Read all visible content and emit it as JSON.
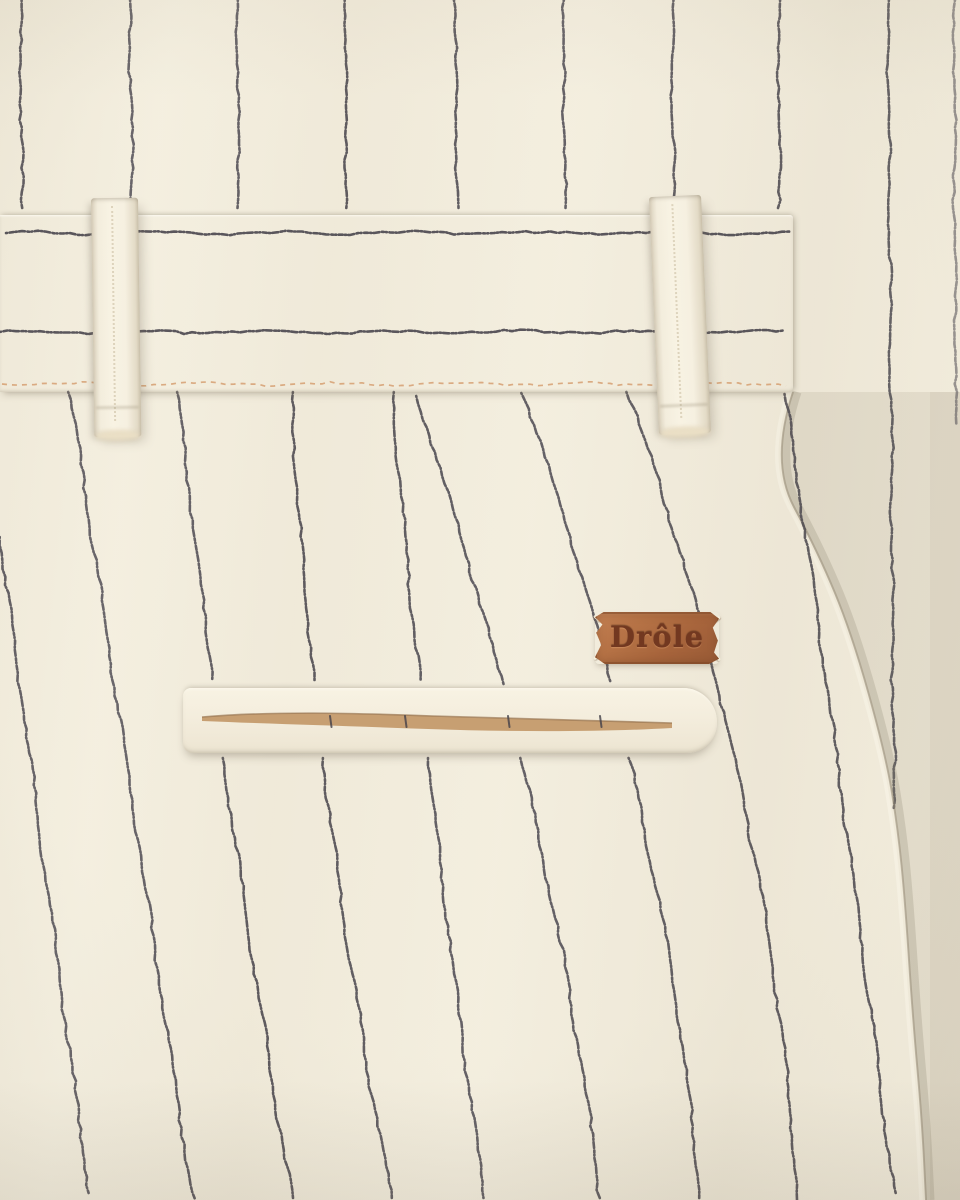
{
  "photo": {
    "subject": "Close-up of cream wool trousers with navy chalk-stripe pattern showing back waistband, belt loops and welt pocket",
    "brand": "Drôle"
  },
  "brand_label": {
    "text": "Drôle",
    "material": "embossed-leather-patch",
    "background": "#ad653a",
    "border": "#8a4c26",
    "text_color": "#6b2d14",
    "stitch_color": "#f6efdc"
  },
  "palette": {
    "fabric_cream": "#f2ecdb",
    "fabric_shadow": "#e4dbc6",
    "stripe_navy": "#3a3740",
    "waistband_highlight": "#f8f2e3",
    "underlayer_shade": "rgba(188,177,154,0.28)",
    "pocket_lining_tan": "#c49a6b",
    "seam_stitch_tan": "#d49a6a"
  },
  "fabric": {
    "stripe_width": 2.6,
    "stripe_opacity": 0.88,
    "dash": "1 2.5 4 2 1.5 2 6 2.5 2 2",
    "top_stripe_y1": 214,
    "top_stripes": [
      20,
      130,
      237,
      345,
      455,
      563,
      672,
      778
    ],
    "long_stripes": [
      {
        "x": 888,
        "drift": 6,
        "y0": 0,
        "y1": 812,
        "opacity": 0.85
      },
      {
        "x": 954,
        "drift": 2,
        "y0": 0,
        "y1": 430,
        "opacity": 0.55
      }
    ],
    "body": {
      "y_top": 392,
      "y_bottom": 1200,
      "stripes": [
        {
          "b0": -20,
          "b1": 90,
          "bow": 0,
          "segs": [
            [
              537,
              1200
            ]
          ]
        },
        {
          "b0": 70,
          "b1": 193,
          "bow": 0,
          "segs": [
            [
              392,
              1200
            ]
          ]
        },
        {
          "b0": 178,
          "b1": 292,
          "bow": -6,
          "segs": [
            [
              392,
              686
            ],
            [
              758,
              1200
            ]
          ]
        },
        {
          "b0": 291,
          "b1": 392,
          "bow": -14,
          "segs": [
            [
              392,
              686
            ],
            [
              758,
              1200
            ]
          ]
        },
        {
          "b0": 392,
          "b1": 485,
          "bow": -6,
          "segs": [
            [
              392,
              686
            ],
            [
              758,
              1200
            ]
          ]
        },
        {
          "b0": 415,
          "b1": 600,
          "bow": 22,
          "segs": [
            [
              396,
              686
            ],
            [
              758,
              1200
            ]
          ]
        },
        {
          "b0": 523,
          "b1": 700,
          "bow": 26,
          "segs": [
            [
              393,
              686
            ],
            [
              758,
              1200
            ]
          ]
        },
        {
          "b0": 628,
          "b1": 797,
          "bow": 30,
          "segs": [
            [
              392,
              1200
            ]
          ]
        },
        {
          "b0": 785,
          "b1": 895,
          "bow": 2,
          "segs": [
            [
              394,
              1200
            ]
          ]
        }
      ]
    },
    "waistband_stripes": [
      {
        "y": 18,
        "x0": 6,
        "x1": 790
      },
      {
        "y": 117,
        "x0": 0,
        "x1": 790
      }
    ],
    "waistband_stitch": {
      "y": 169,
      "x0": 2,
      "x1": 788
    },
    "edge_path": [
      [
        793,
        392
      ],
      [
        770,
        462
      ],
      [
        818,
        552
      ],
      [
        852,
        634
      ],
      [
        886,
        756
      ],
      [
        898,
        830
      ],
      [
        905,
        900
      ],
      [
        913,
        1020
      ],
      [
        922,
        1120
      ],
      [
        926,
        1200
      ]
    ]
  },
  "pocket": {
    "slit_marks": [
      147,
      222,
      325,
      417
    ]
  }
}
